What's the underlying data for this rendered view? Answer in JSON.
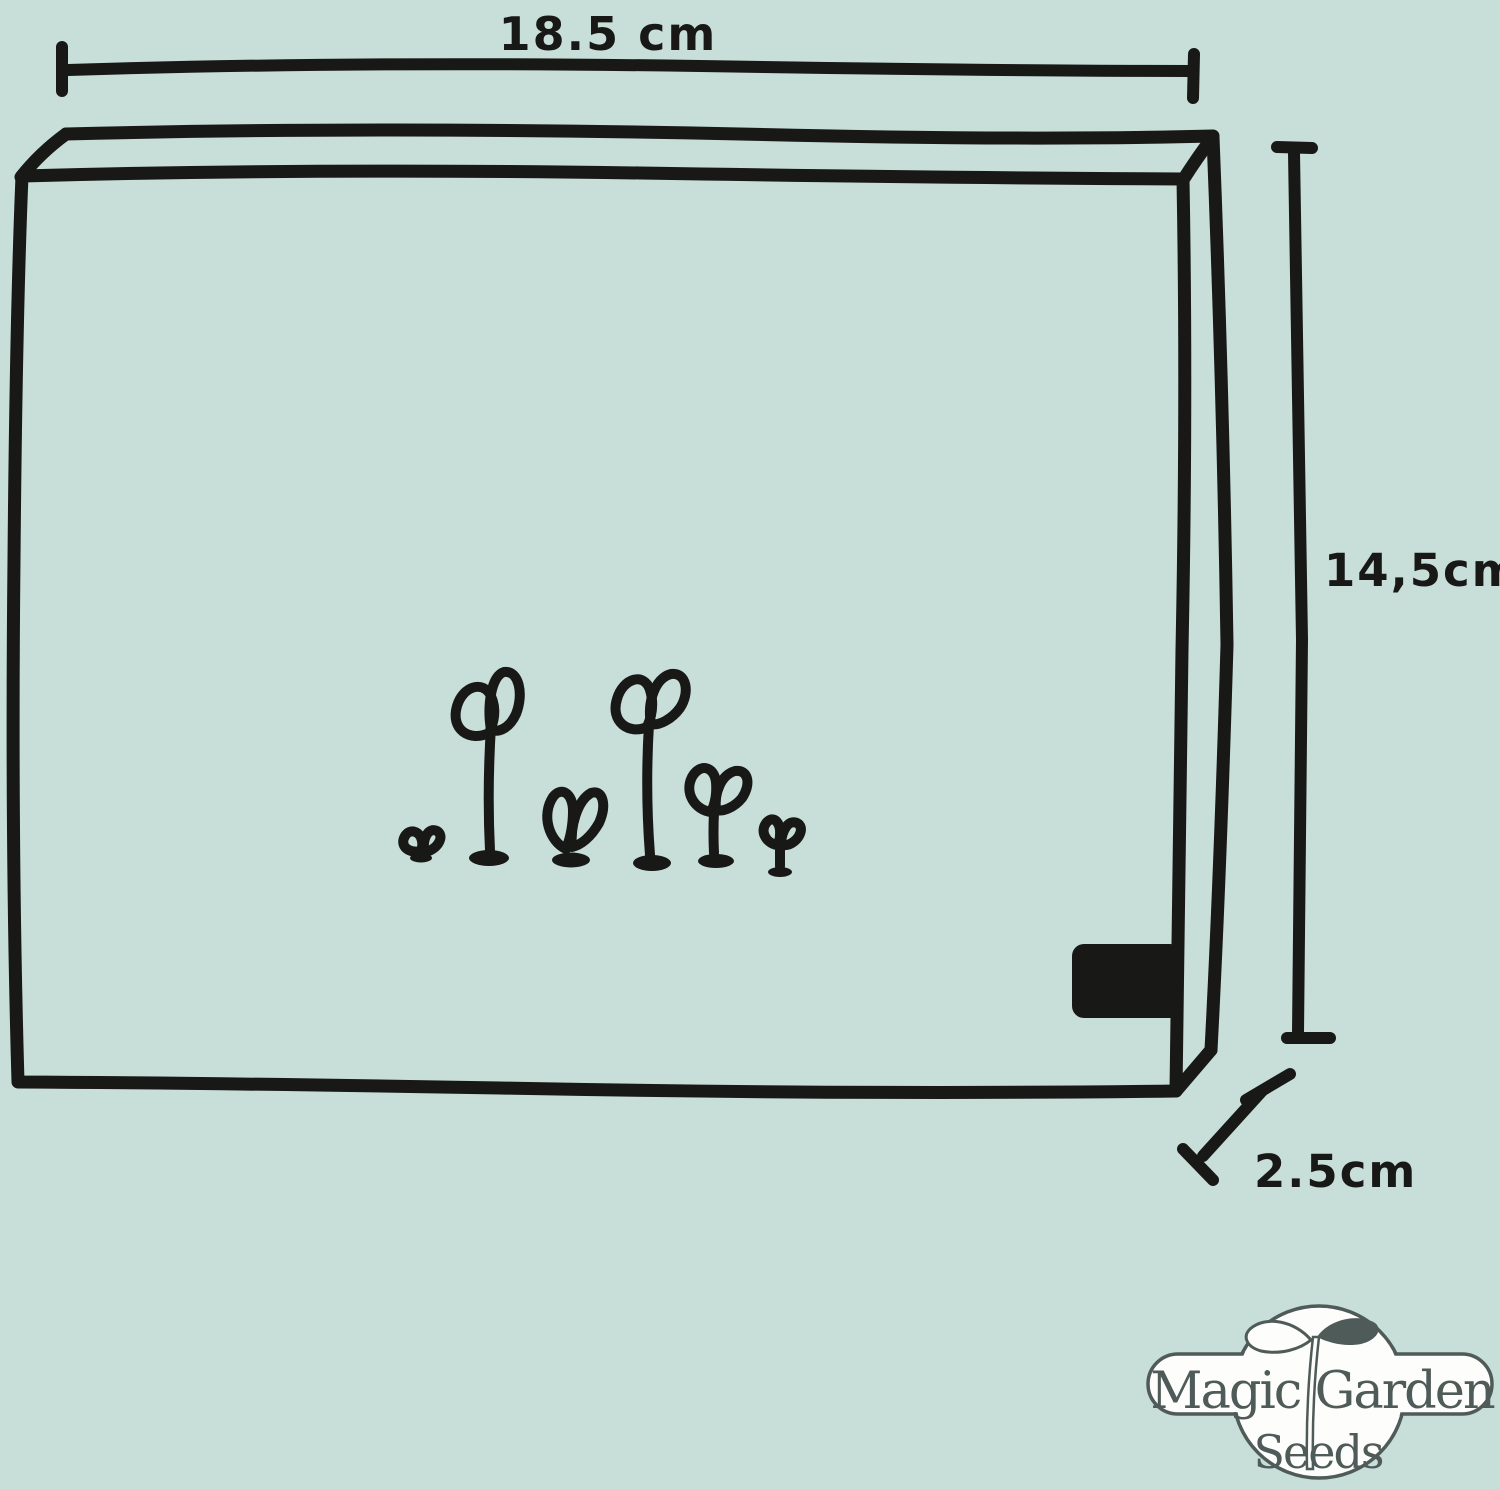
{
  "diagram": {
    "width_label": "18.5 cm",
    "height_label": "14,5cm",
    "depth_label": "2.5cm",
    "seedling_count": 6
  },
  "logo": {
    "line1": "Magic Garden",
    "line2": "Seeds"
  },
  "colors": {
    "background": "#c8ded9",
    "ink": "#181817",
    "logo_line": "#4f5b58",
    "logo_fill": "#fdfdfc"
  }
}
